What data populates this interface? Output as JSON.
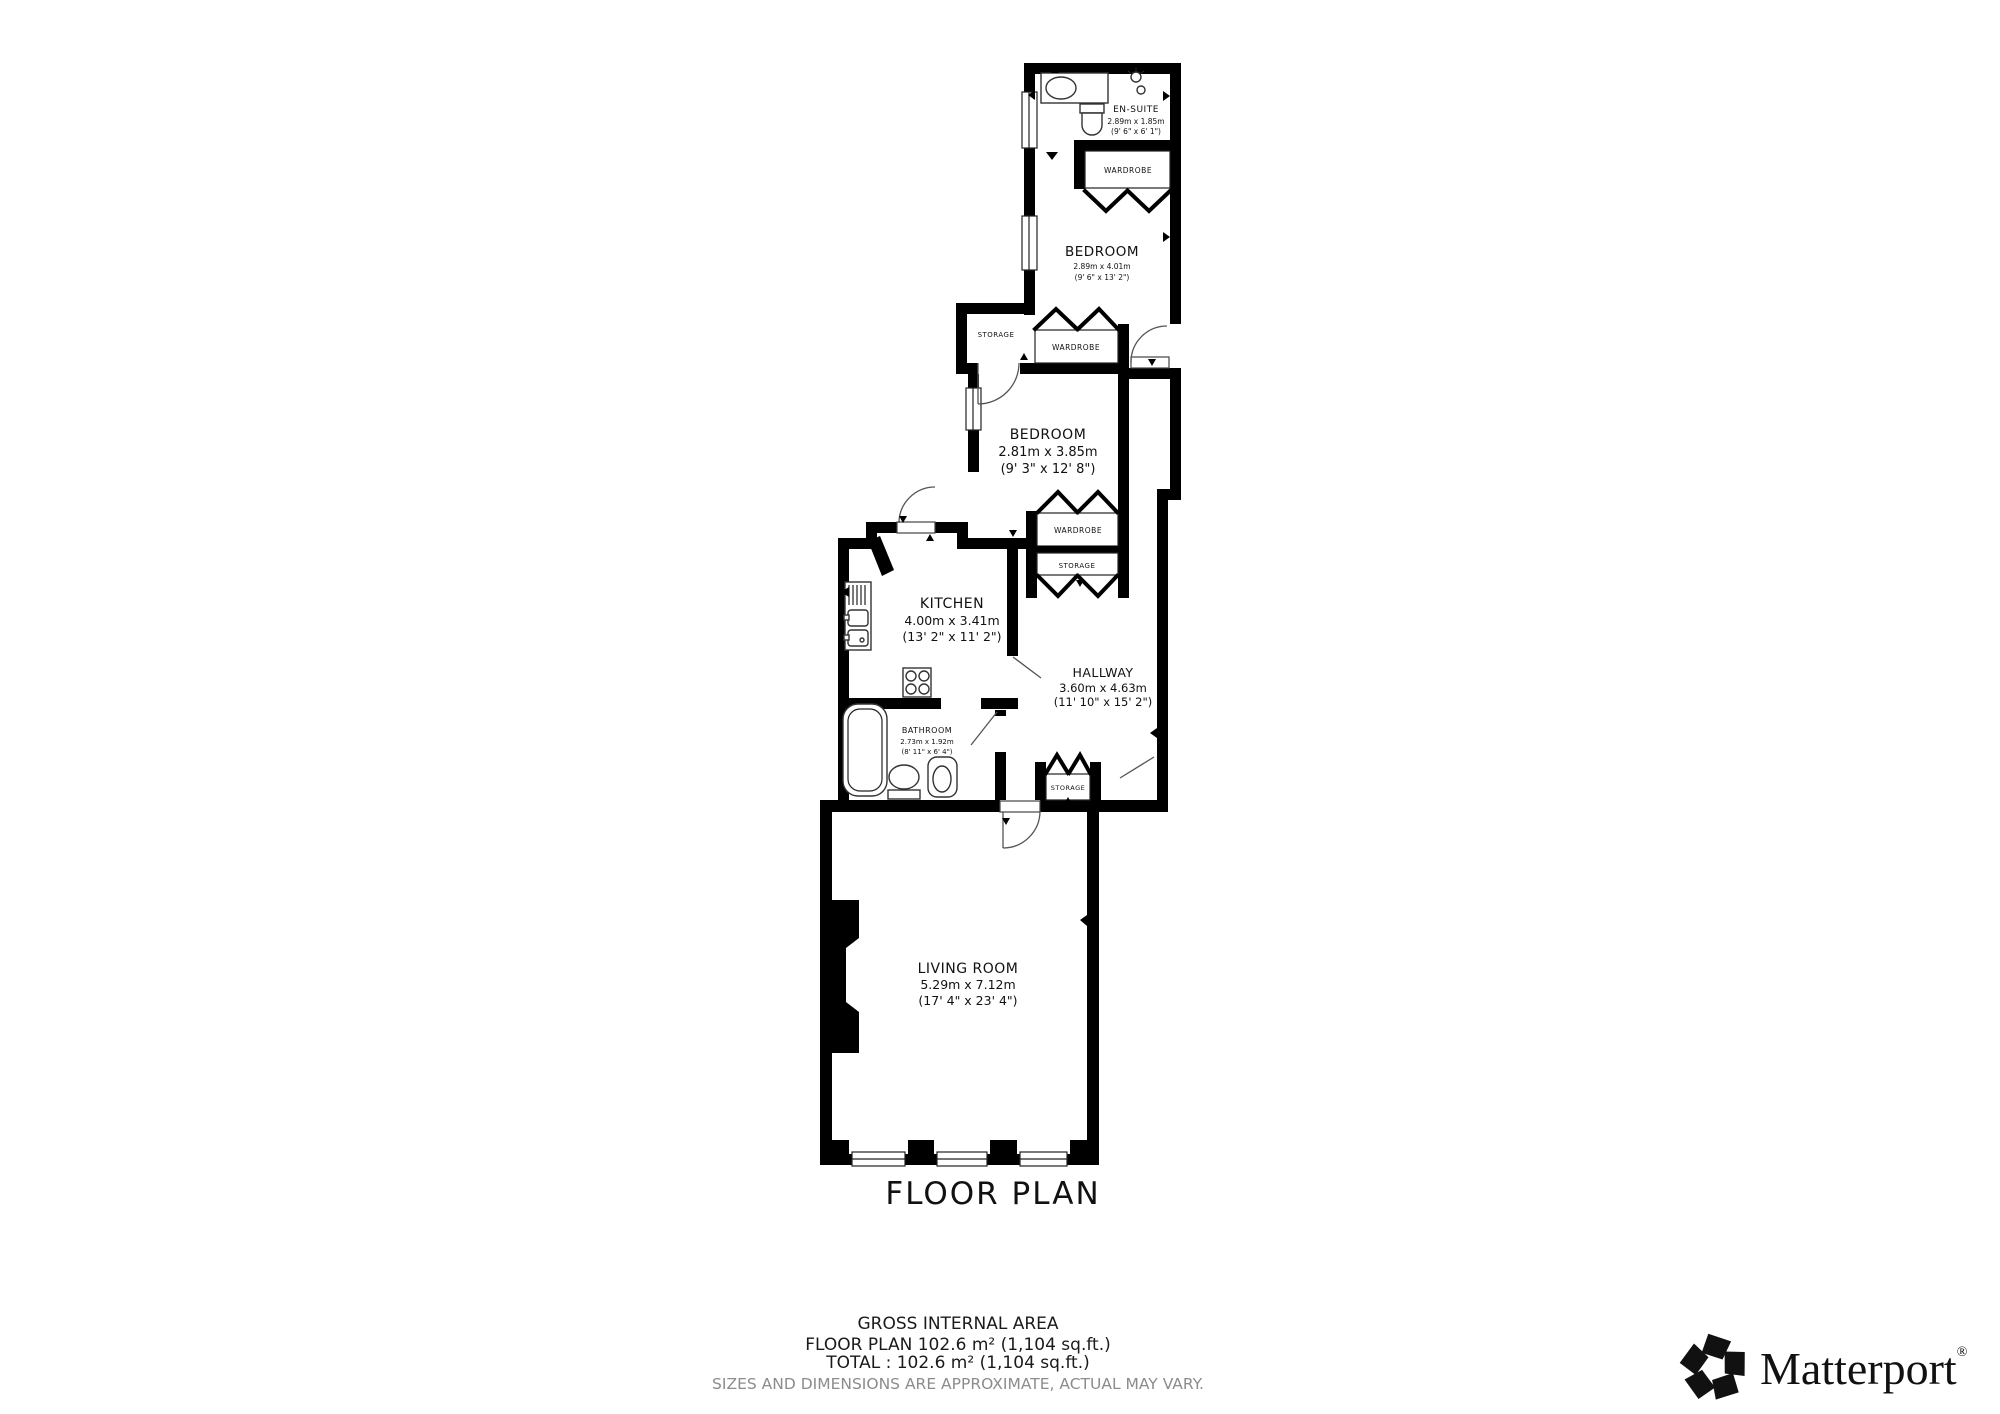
{
  "plan": {
    "title": "FLOOR PLAN",
    "rooms": {
      "en_suite": {
        "name": "EN-SUITE",
        "metric": "2.89m x 1.85m",
        "imperial": "(9' 6\" x 6' 1\")"
      },
      "bedroom_top": {
        "name": "BEDROOM",
        "metric": "2.89m x 4.01m",
        "imperial": "(9' 6\" x 13' 2\")"
      },
      "bedroom_mid": {
        "name": "BEDROOM",
        "metric": "2.81m x 3.85m",
        "imperial": "(9' 3\" x 12' 8\")"
      },
      "kitchen": {
        "name": "KITCHEN",
        "metric": "4.00m x 3.41m",
        "imperial": "(13' 2\" x 11' 2\")"
      },
      "hallway": {
        "name": "HALLWAY",
        "metric": "3.60m x 4.63m",
        "imperial": "(11' 10\" x 15' 2\")"
      },
      "bathroom": {
        "name": "BATHROOM",
        "metric": "2.73m x 1.92m",
        "imperial": "(8' 11\" x 6' 4\")"
      },
      "living_room": {
        "name": "LIVING ROOM",
        "metric": "5.29m x 7.12m",
        "imperial": "(17' 4\" x 23' 4\")"
      }
    },
    "closets": {
      "wardrobe": "WARDROBE",
      "storage": "STORAGE"
    }
  },
  "footer": {
    "line1": "GROSS INTERNAL AREA",
    "line2": "FLOOR PLAN 102.6 m² (1,104 sq.ft.)",
    "line3": "TOTAL :  102.6 m² (1,104 sq.ft.)",
    "disclaimer": "SIZES AND DIMENSIONS ARE APPROXIMATE, ACTUAL MAY VARY."
  },
  "brand": {
    "name": "Matterport",
    "registered": "®",
    "icon": "matterport-pinwheel-logo-icon"
  },
  "colors": {
    "walls": "#000000",
    "text": "#1a1a1a",
    "disclaimer_gray": "#8c8c8c",
    "background": "#ffffff",
    "door_arc": "#555555"
  }
}
